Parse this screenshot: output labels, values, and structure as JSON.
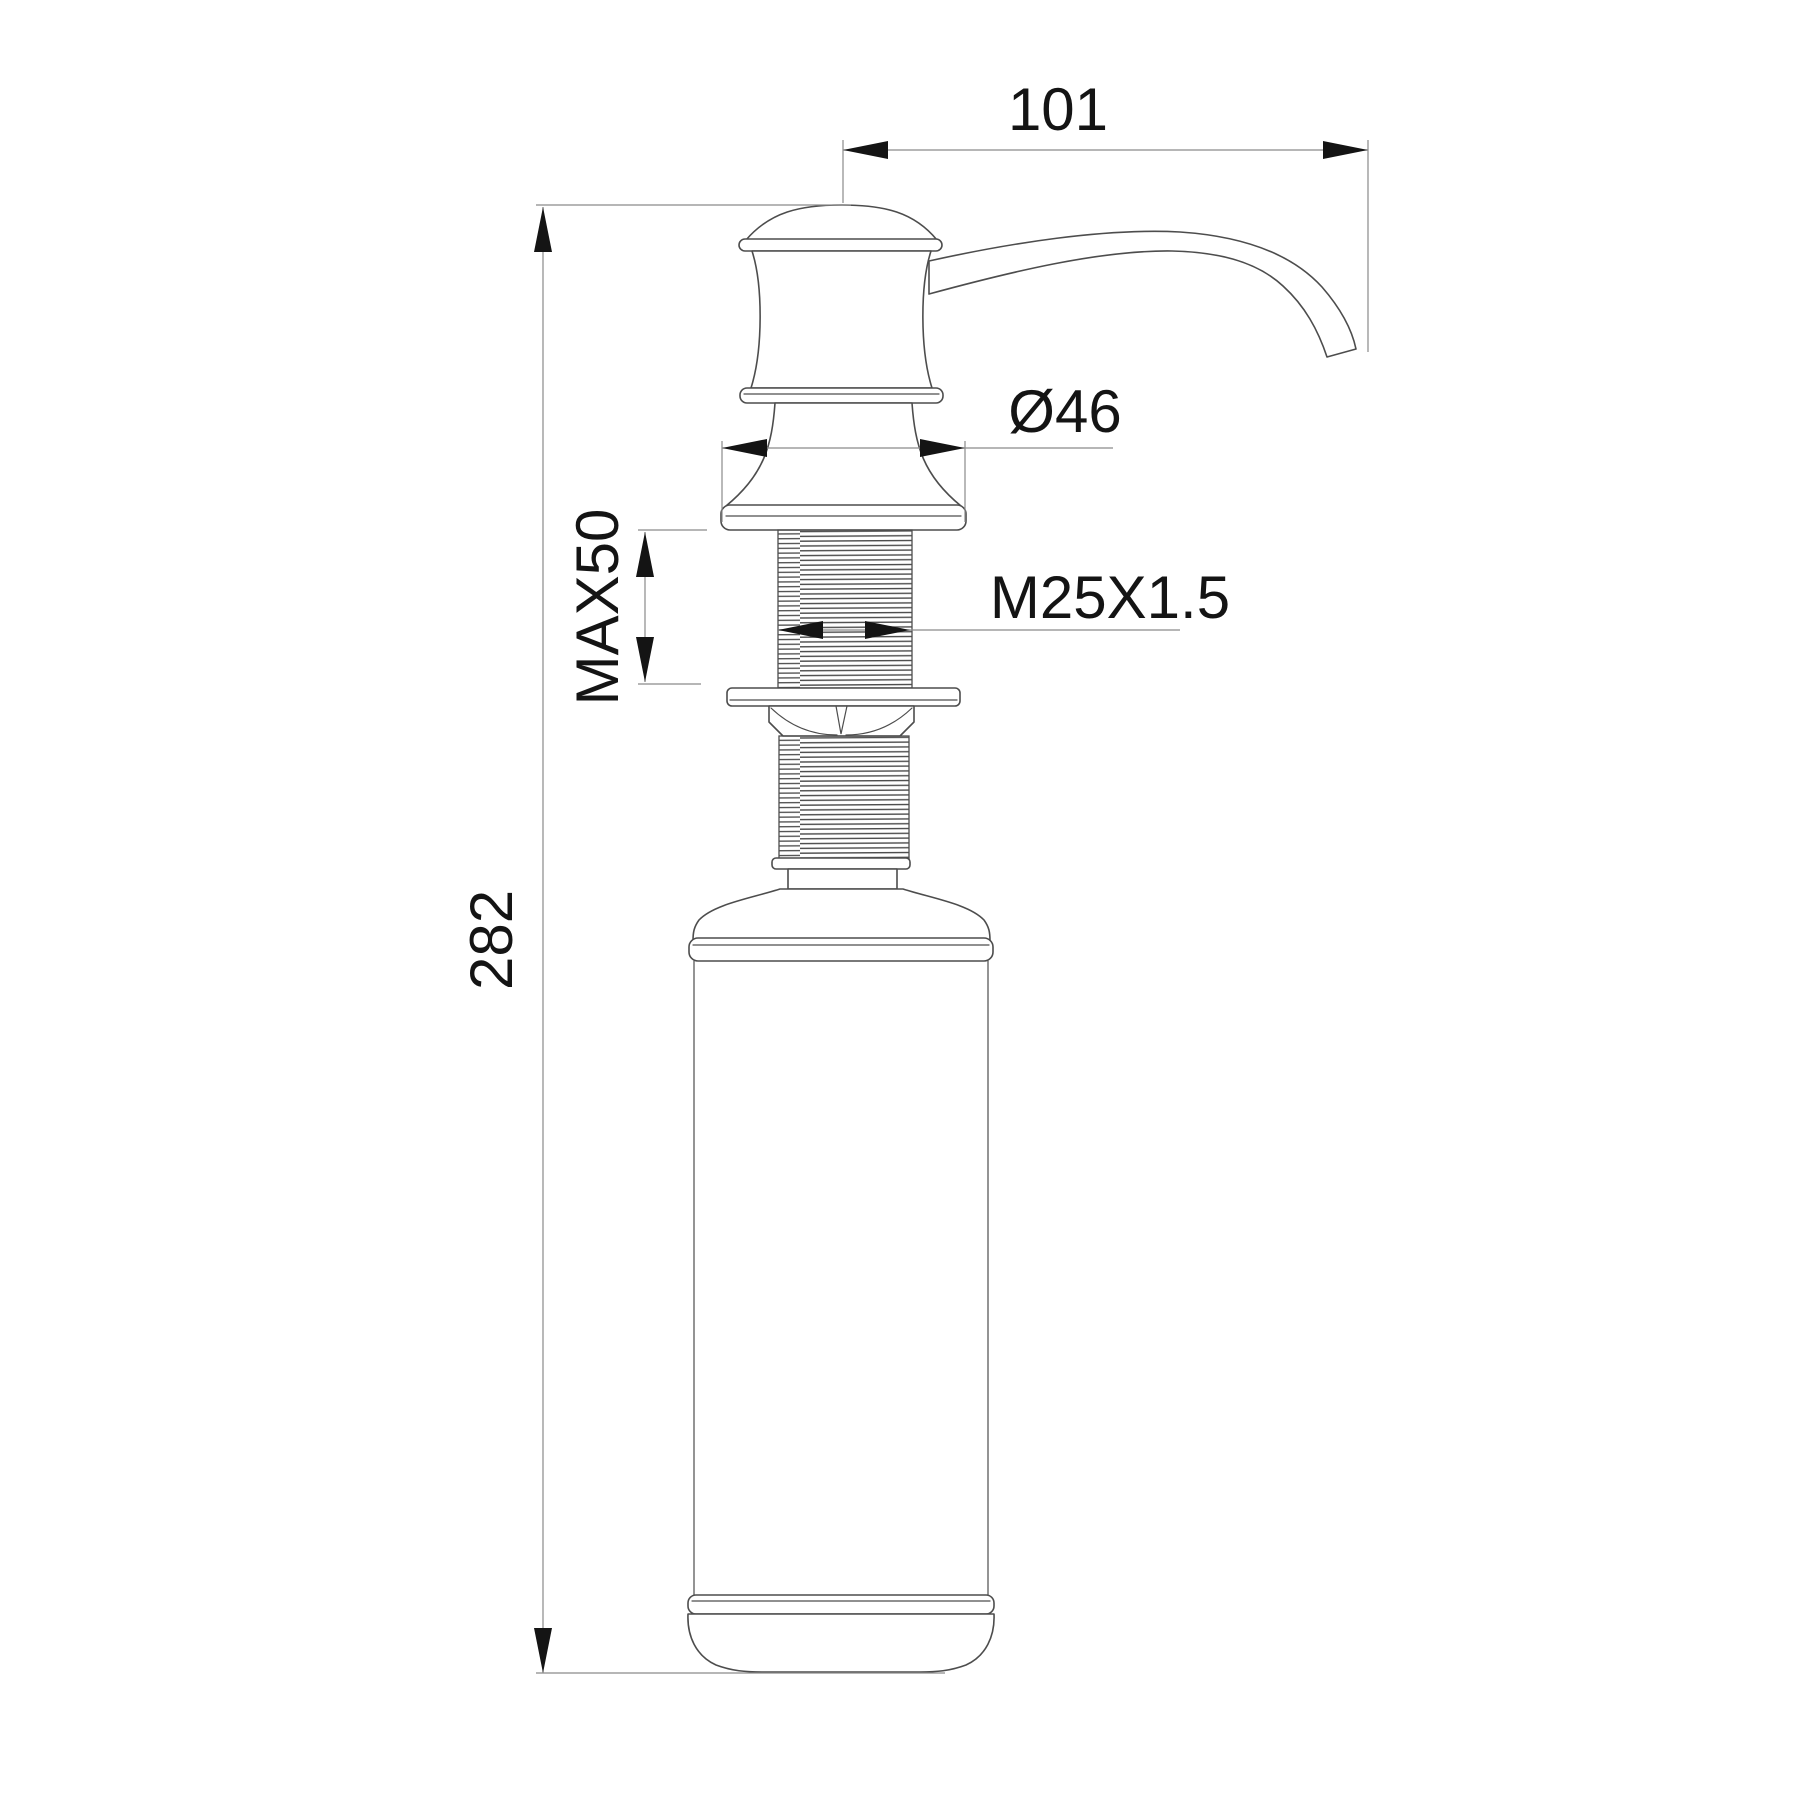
{
  "drawing": {
    "labels": {
      "spout_reach": "101",
      "head_diameter": "Ø46",
      "max_mounting_depth": "MAX50",
      "thread_spec": "M25X1.5",
      "total_height": "282"
    },
    "colors": {
      "object_line": "#4d4d4d",
      "dimension_line": "#8a8a8a",
      "text": "#141414",
      "background": "#ffffff"
    }
  }
}
